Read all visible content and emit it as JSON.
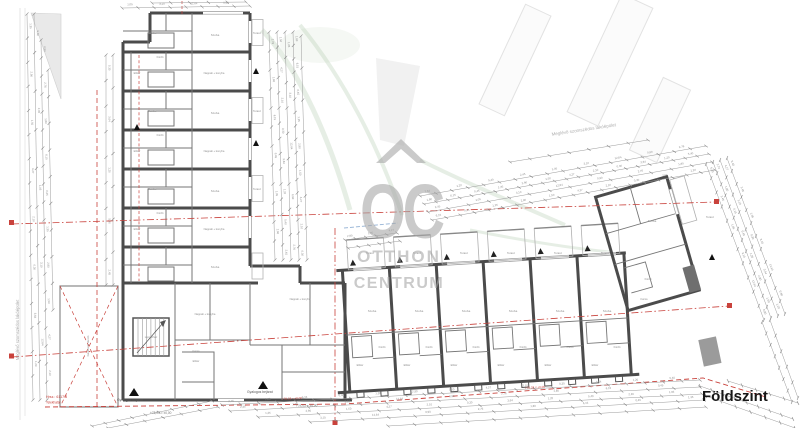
{
  "page": {
    "width": 800,
    "height": 428,
    "background": "#ffffff"
  },
  "title": {
    "label": "Földszint"
  },
  "watermark": {
    "monogram": "OC",
    "line1": "OTTHON",
    "line2": "CENTRUM",
    "color": "#a8a8a8"
  },
  "neighbors": {
    "top_label": "Meglévő szomszédos lakóépület",
    "left_label": "Meglévő szomszédos lakóépület"
  },
  "boundary": {
    "parcel_number": "Hrsz.: 6117/8",
    "boundary_label": "Telekhatár",
    "color": "#c9423c"
  },
  "entrances": {
    "labels": [
      "Gyalogos bejárat",
      "Gyalogos bejárat"
    ]
  },
  "levels": {
    "ground_reference": "+78,03 = ±0,00"
  },
  "room_labels": [
    {
      "text": "Szoba",
      "size": 3,
      "positions": [
        [
          152,
          34
        ],
        [
          152,
          112
        ],
        [
          152,
          190
        ],
        [
          215,
          36
        ],
        [
          215,
          114
        ],
        [
          215,
          192
        ],
        [
          215,
          268
        ],
        [
          372,
          312
        ],
        [
          419,
          312
        ],
        [
          466,
          312
        ],
        [
          513,
          312
        ],
        [
          560,
          312
        ],
        [
          607,
          312
        ],
        [
          652,
          222
        ]
      ]
    },
    {
      "text": "Nappali + konyha",
      "size": 2.7,
      "positions": [
        [
          214,
          74
        ],
        [
          214,
          152
        ],
        [
          214,
          230
        ],
        [
          205,
          315
        ],
        [
          300,
          300
        ]
      ]
    },
    {
      "text": "Fürdő",
      "size": 2.6,
      "positions": [
        [
          160,
          58
        ],
        [
          160,
          136
        ],
        [
          160,
          214
        ],
        [
          382,
          348
        ],
        [
          429,
          348
        ],
        [
          476,
          348
        ],
        [
          523,
          348
        ],
        [
          570,
          348
        ],
        [
          617,
          348
        ],
        [
          648,
          280
        ]
      ]
    },
    {
      "text": "Előtér",
      "size": 2.6,
      "positions": [
        [
          137,
          74
        ],
        [
          137,
          152
        ],
        [
          137,
          230
        ],
        [
          196,
          362
        ],
        [
          360,
          366
        ],
        [
          407,
          366
        ],
        [
          454,
          366
        ],
        [
          501,
          366
        ],
        [
          548,
          366
        ],
        [
          595,
          366
        ]
      ]
    },
    {
      "text": "Terasz",
      "size": 2.7,
      "positions": [
        [
          370,
          254
        ],
        [
          417,
          254
        ],
        [
          464,
          254
        ],
        [
          511,
          254
        ],
        [
          558,
          254
        ],
        [
          605,
          254
        ],
        [
          257,
          34
        ],
        [
          257,
          112
        ],
        [
          257,
          190
        ],
        [
          710,
          218
        ]
      ]
    },
    {
      "text": "Lépcsőház",
      "size": 2.6,
      "positions": [
        [
          151,
          338
        ]
      ]
    },
    {
      "text": "Gépkocsi tároló",
      "size": 3,
      "rot": -90,
      "positions": [
        [
          89,
          346
        ]
      ]
    },
    {
      "text": "Kamra",
      "size": 2.4,
      "positions": [
        [
          196,
          352
        ],
        [
          644,
          300
        ]
      ]
    }
  ],
  "red_refs": [
    "+78,03 = ±0,00",
    "+78,03 = ±0,00"
  ],
  "dim_values": [
    "1,35",
    "2,90",
    "1,50",
    "4,27",
    "2,10",
    "0,30",
    "3,64",
    "1,20",
    "5,40",
    "2,45",
    "1,05",
    "3,10",
    "12,64",
    "0,90",
    "2,76",
    "1,80",
    "6,15",
    "0,45"
  ],
  "colors": {
    "wall": "#4b4b4b",
    "partition": "#767676",
    "light_line": "#b0b0b0",
    "dimension": "#9b9b9b",
    "dim_text": "#8a8a8a",
    "section_red": "#c9423c",
    "green": "#a9c6a4",
    "blue": "#86a8cf",
    "shade": "#e9e9e9",
    "dark_fill": "#6f6f6f"
  }
}
